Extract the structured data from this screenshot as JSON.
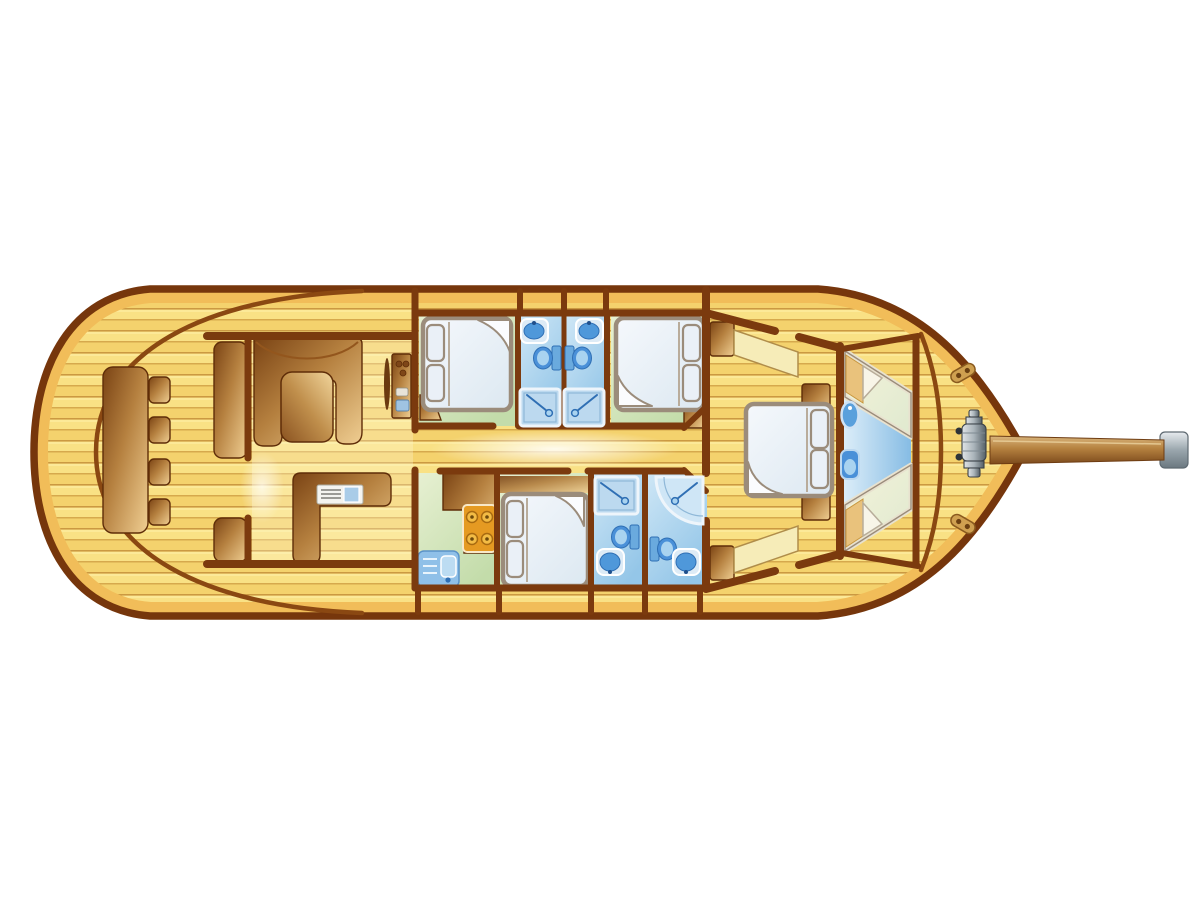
{
  "meta": {
    "type": "yacht-deck-floor-plan",
    "orientation": "bow-right-stern-left",
    "background_note": "isolated plan on white background"
  },
  "palette": {
    "background": "#ffffff",
    "hull_outline": "#76360c",
    "rim": "#f1bd59",
    "wall": "#7b3a0e",
    "wall_thin": "#8a4812",
    "plank_base": "#f8dd7d",
    "plank_alt": "#f3cf69",
    "plank_line": "#c6913a",
    "plank_highlight": "#fdeea2",
    "wood_dark": "#7a4314",
    "wood_mid": "#b5803f",
    "wood_light": "#f0cf93",
    "floor_green_light": "#e7f0d2",
    "floor_green_dark": "#c3dcaa",
    "floor_blue_light": "#cfe7f6",
    "floor_blue_dark": "#94c6e8",
    "bed_outline": "#9b8c7b",
    "bed_fill": "#f4f7fb",
    "fixture_blue": "#4a90d8",
    "fixture_blue_light": "#a9d3f0",
    "fixture_blue_dark": "#2f6fb4",
    "stove_orange": "#e59a22",
    "burner_orange": "#f3bc45",
    "metal_light": "#e0e4e7",
    "metal_dark": "#545f66",
    "bowsprit_light": "#d9b57c",
    "bowsprit_dark": "#7c4a1c",
    "berth_pillow": "#e9c27c",
    "wedge_blue": "#86bce4"
  },
  "rooms": [
    {
      "id": "aft-deck",
      "name": "Aft deck cockpit",
      "items": [
        "long table",
        "stool",
        "stool",
        "stool",
        "stool",
        "bench seat",
        "bench seat"
      ]
    },
    {
      "id": "salon",
      "name": "Deck salon",
      "items": [
        "U-shaped settee",
        "salon table",
        "helm station with wheel and instruments",
        "L-shaped counter with sink unit"
      ]
    },
    {
      "id": "cabin-1",
      "name": "Guest cabin port-forward",
      "items": [
        "double bed with two pillows",
        "corner locker"
      ]
    },
    {
      "id": "bathroom-1",
      "name": "Bathroom 1",
      "items": [
        "washbasin",
        "toilet",
        "shower"
      ]
    },
    {
      "id": "bathroom-2",
      "name": "Bathroom 2",
      "items": [
        "washbasin",
        "toilet",
        "shower"
      ]
    },
    {
      "id": "cabin-2",
      "name": "Guest cabin starboard-forward",
      "items": [
        "double bed with two pillows",
        "corner locker"
      ]
    },
    {
      "id": "galley",
      "name": "Galley",
      "items": [
        "L-counter",
        "four-burner stove",
        "sink unit with drawers"
      ]
    },
    {
      "id": "cabin-3",
      "name": "Guest cabin amidships",
      "items": [
        "double bed with two pillows",
        "locker"
      ]
    },
    {
      "id": "bathroom-3",
      "name": "Bathroom 3",
      "items": [
        "shower",
        "toilet",
        "washbasin"
      ]
    },
    {
      "id": "bathroom-4",
      "name": "Master ensuite bathroom",
      "items": [
        "corner shower",
        "toilet",
        "washbasin"
      ]
    },
    {
      "id": "master-cabin",
      "name": "Master cabin",
      "items": [
        "double bed with two pillows",
        "two angled settees",
        "two nightstands"
      ]
    },
    {
      "id": "v-berth-cabin",
      "name": "Forward V-berth cabin",
      "items": [
        "single berth",
        "single berth",
        "washbasin",
        "toilet"
      ]
    },
    {
      "id": "foredeck",
      "name": "Foredeck",
      "items": [
        "anchor windlass",
        "cleat",
        "cleat",
        "bowsprit"
      ]
    }
  ],
  "counts": {
    "cabins": 5,
    "bathrooms": 4,
    "double_beds": 4,
    "single_berths": 2,
    "stools": 4
  }
}
